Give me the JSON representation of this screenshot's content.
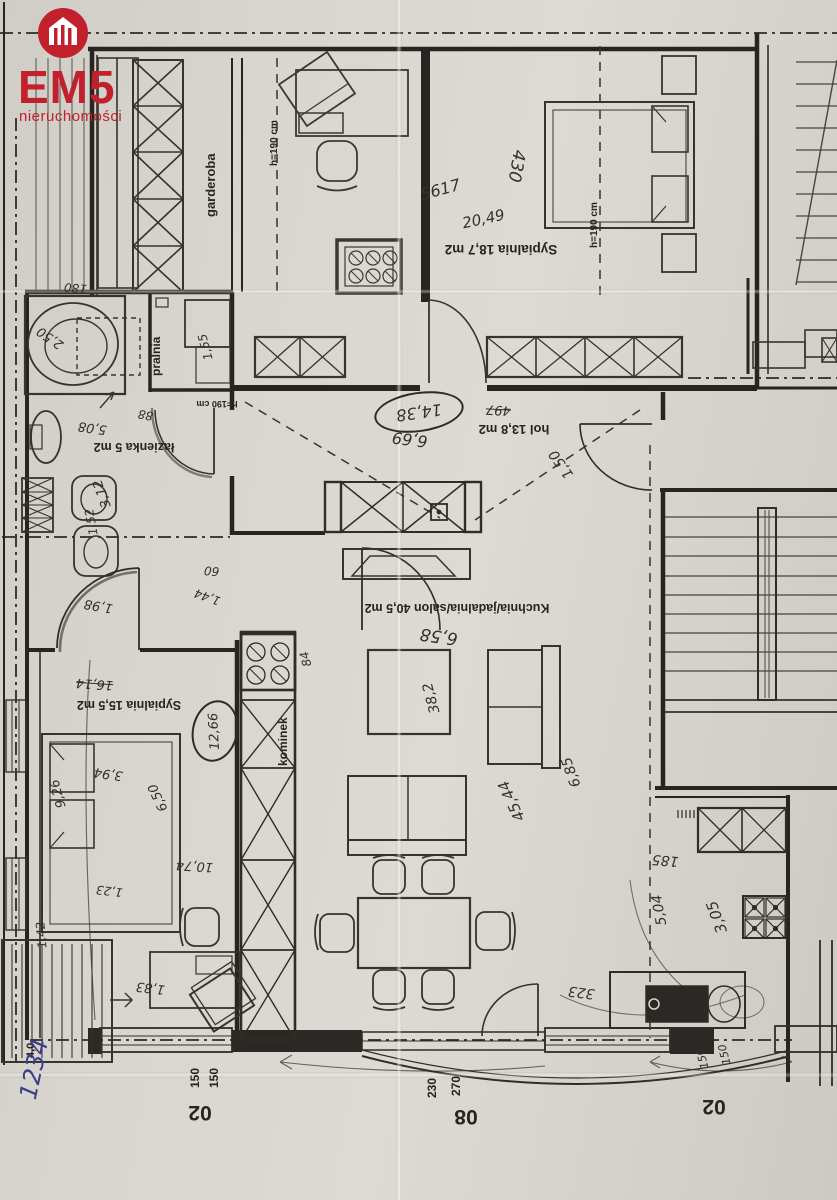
{
  "logo": {
    "brand": "EM5",
    "tagline": "nieruchomości",
    "accent_color": "#c2202c",
    "icon": "house-icon"
  },
  "rooms": {
    "garderoba": "garderoba",
    "bedroom1": "Sypialnia 18,7 m2",
    "laundry": "pralnia",
    "bathroom": "łazienka 5 m2",
    "hall": "hol 13,8 m2",
    "living": "Kuchnia/jadalnia/salon 40,5 m2",
    "bedroom2": "Sypialnia 15,5 m2",
    "fireplace": "kominek"
  },
  "notes": {
    "h1": "h=190 cm",
    "h2": "h=190 cm",
    "h3": "h=190 cm"
  },
  "dimensions": {
    "left_window_1": "150",
    "left_window_2": "150",
    "balcony_door_1": "270",
    "balcony_door_2": "230",
    "right_window_1": "150",
    "right_window_2": "150",
    "code_left": "02",
    "code_center": "08",
    "code_right": "02",
    "left_balcony": "4,0"
  },
  "handwritten": {
    "bed1_a": "430",
    "bed1_b": "5617",
    "bed1_c": "20,49",
    "hall_circled": "14,38",
    "hall_len": "6,69",
    "hall_crossed": "497",
    "hall_diag": "1,50",
    "bath_180": "180",
    "bath_tub": "2,50",
    "bath_area": "5,08",
    "bath_w": "88",
    "bath_h": "3,12",
    "bath_v": "1,52",
    "laundry_dim": "1,55",
    "door_60": "60",
    "door_144": "1,44",
    "door_198": "1,98",
    "living_w": "6,58",
    "living_area": "38,2",
    "living_d1": "6,85",
    "living_d2": "45,44",
    "bed2_crossed": "16,14",
    "bed2_circled": "12,66",
    "bed2_a": "3,94",
    "bed2_b": "9,26",
    "bed2_c": "6,50",
    "bed2_d": "10,74",
    "bed2_e": "1,83",
    "bed2_f": "1,23",
    "bed2_g": "1,42",
    "fire_side": "84",
    "kit_a": "185",
    "kit_b": "3,05",
    "kit_c": "5,04",
    "kit_d": "323",
    "kit_e": "150",
    "kit_f": "150",
    "pen_code": "1234"
  }
}
